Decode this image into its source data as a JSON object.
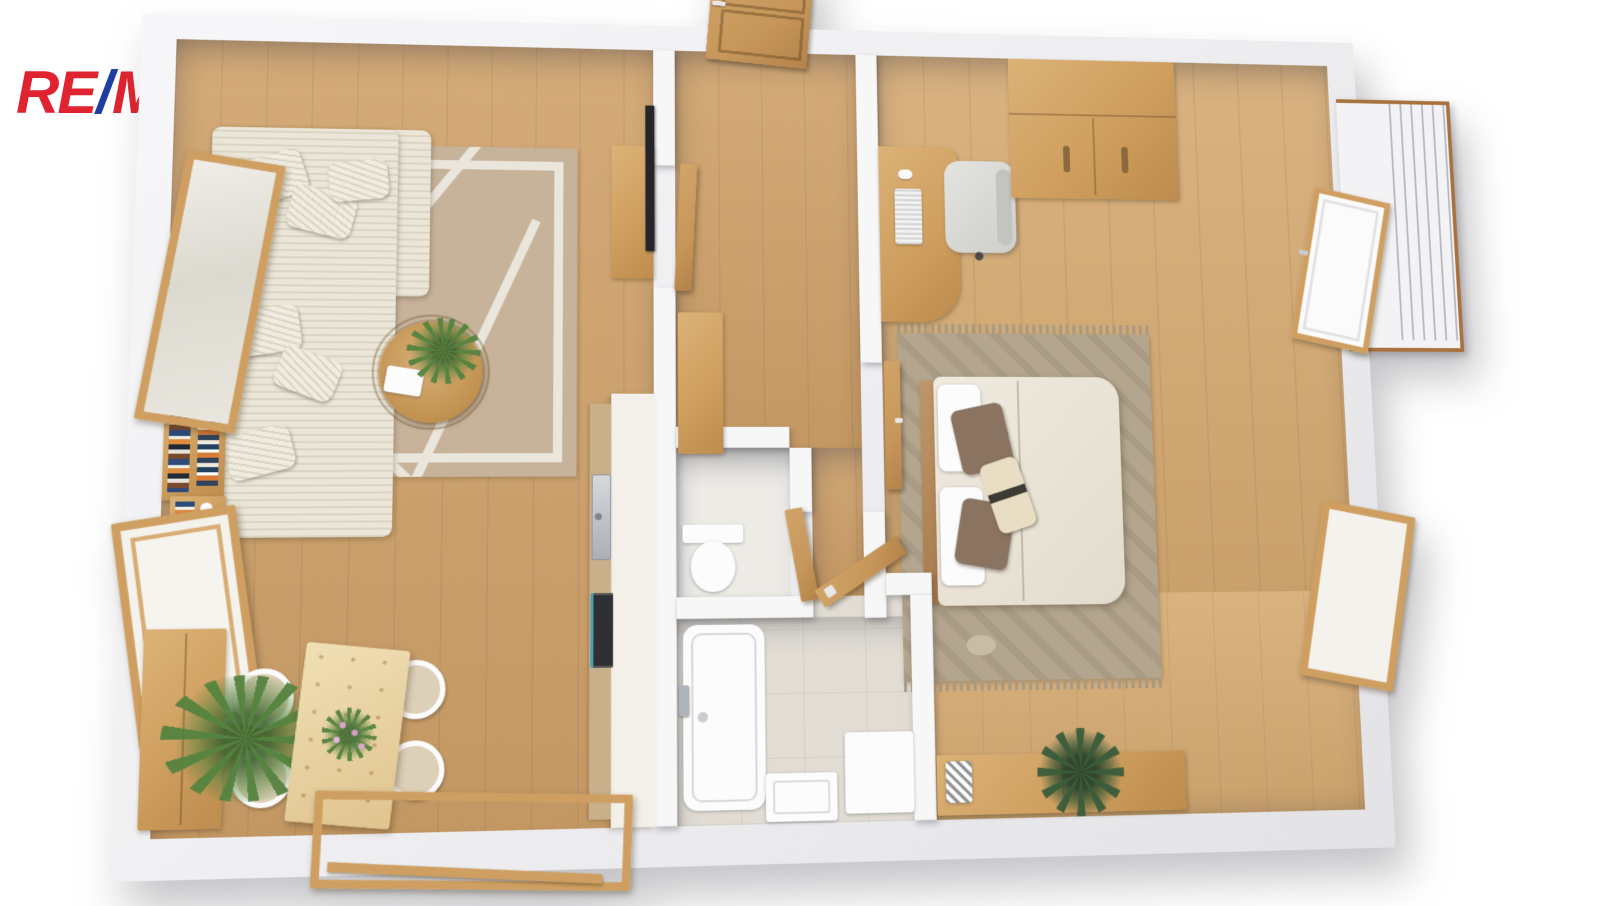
{
  "logo": {
    "re": "RE",
    "slash": "/",
    "max": "MAX"
  },
  "colors": {
    "brand_red": "#E02330",
    "brand_blue": "#1E3EA3",
    "wall": "#F7F7F8",
    "wall_band": "#EDEDEF",
    "wood": "#CFA169",
    "wood_light": "#D5AA72",
    "furn_wood": "#CF9F5F",
    "door_wood": "#C6965A",
    "pale_wood": "#EAD4A6",
    "counter": "#F3F0E9",
    "counter_wood": "#C9B08B",
    "tile": "#E1DDD4",
    "wc_tile": "#EDEBE6",
    "sofa": "#EBE6D8",
    "rug": "#C7B29A",
    "rug_line": "#EAE6DC",
    "bedrug": "#B4A68E",
    "rail_wood": "#A9713D",
    "metal": "#B6BAC0",
    "plant": "#55833F",
    "plant_dark": "#3A5C3B",
    "tv": "#26262A",
    "teal": "#4BA0B4",
    "white_obj": "#FCFCFD"
  }
}
